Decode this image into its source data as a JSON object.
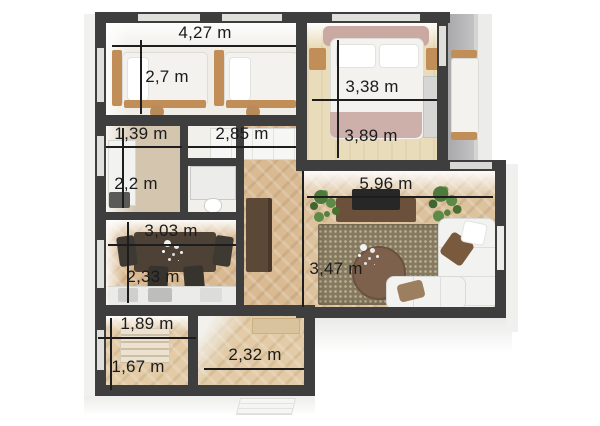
{
  "plan": {
    "rooms": [
      {
        "id": "kids-bedroom",
        "width_label": "4,27 m",
        "depth_label": "2,7 m"
      },
      {
        "id": "bedroom",
        "width_label": "3,38 m",
        "depth_label": "3,89 m"
      },
      {
        "id": "bathroom",
        "width_label": "1,39 m",
        "depth_label": "2,2 m"
      },
      {
        "id": "hallway",
        "width_label": "2,85 m"
      },
      {
        "id": "living-room",
        "width_label": "5,96 m",
        "depth_label": "3,47 m"
      },
      {
        "id": "kitchen",
        "width_label": "3,03 m",
        "depth_label": "2,33 m"
      },
      {
        "id": "storage",
        "width_label": "1,89 m",
        "depth_label": "1,67 m"
      },
      {
        "id": "entry",
        "width_label": "2,32 m"
      }
    ],
    "colors": {
      "wall": "#3e3e3e",
      "wood_floor": "#d9ba92",
      "pale_floor": "#e9dcba",
      "rug": "#85795f",
      "plant": "#4e7a3b",
      "text": "#1b1b1b",
      "background": "#ffffff"
    }
  }
}
